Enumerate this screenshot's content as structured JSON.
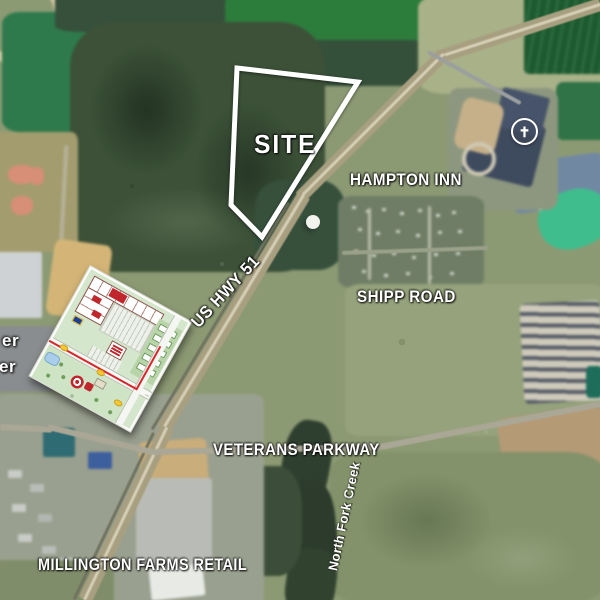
{
  "map": {
    "title": "Millington site aerial map",
    "labels": {
      "site": "SITE",
      "hampton_inn": "HAMPTON INN",
      "shipp_road": "SHIPP ROAD",
      "us_hwy_51": "US HWY 51",
      "veterans_parkway": "VETERANS PARKWAY",
      "millington_farms_retail": "MILLINGTON FARMS RETAIL",
      "north_fork_creek": "North Fork Creek",
      "left_edge_fragment_1": "er",
      "left_edge_fragment_2": "er"
    },
    "icons": {
      "church_cross": "✝"
    },
    "colors": {
      "label_text": "#ffffff",
      "site_outline": "#ffffff",
      "pond_teal": "#3fbd8c",
      "highway_tan": "#a89f80",
      "forest_dark": "#3a5138",
      "field_green": "#2e7a4c",
      "inset_red": "#c0272d",
      "inset_shield_yellow": "#f7c733",
      "inset_blue": "#1c3f94"
    }
  }
}
